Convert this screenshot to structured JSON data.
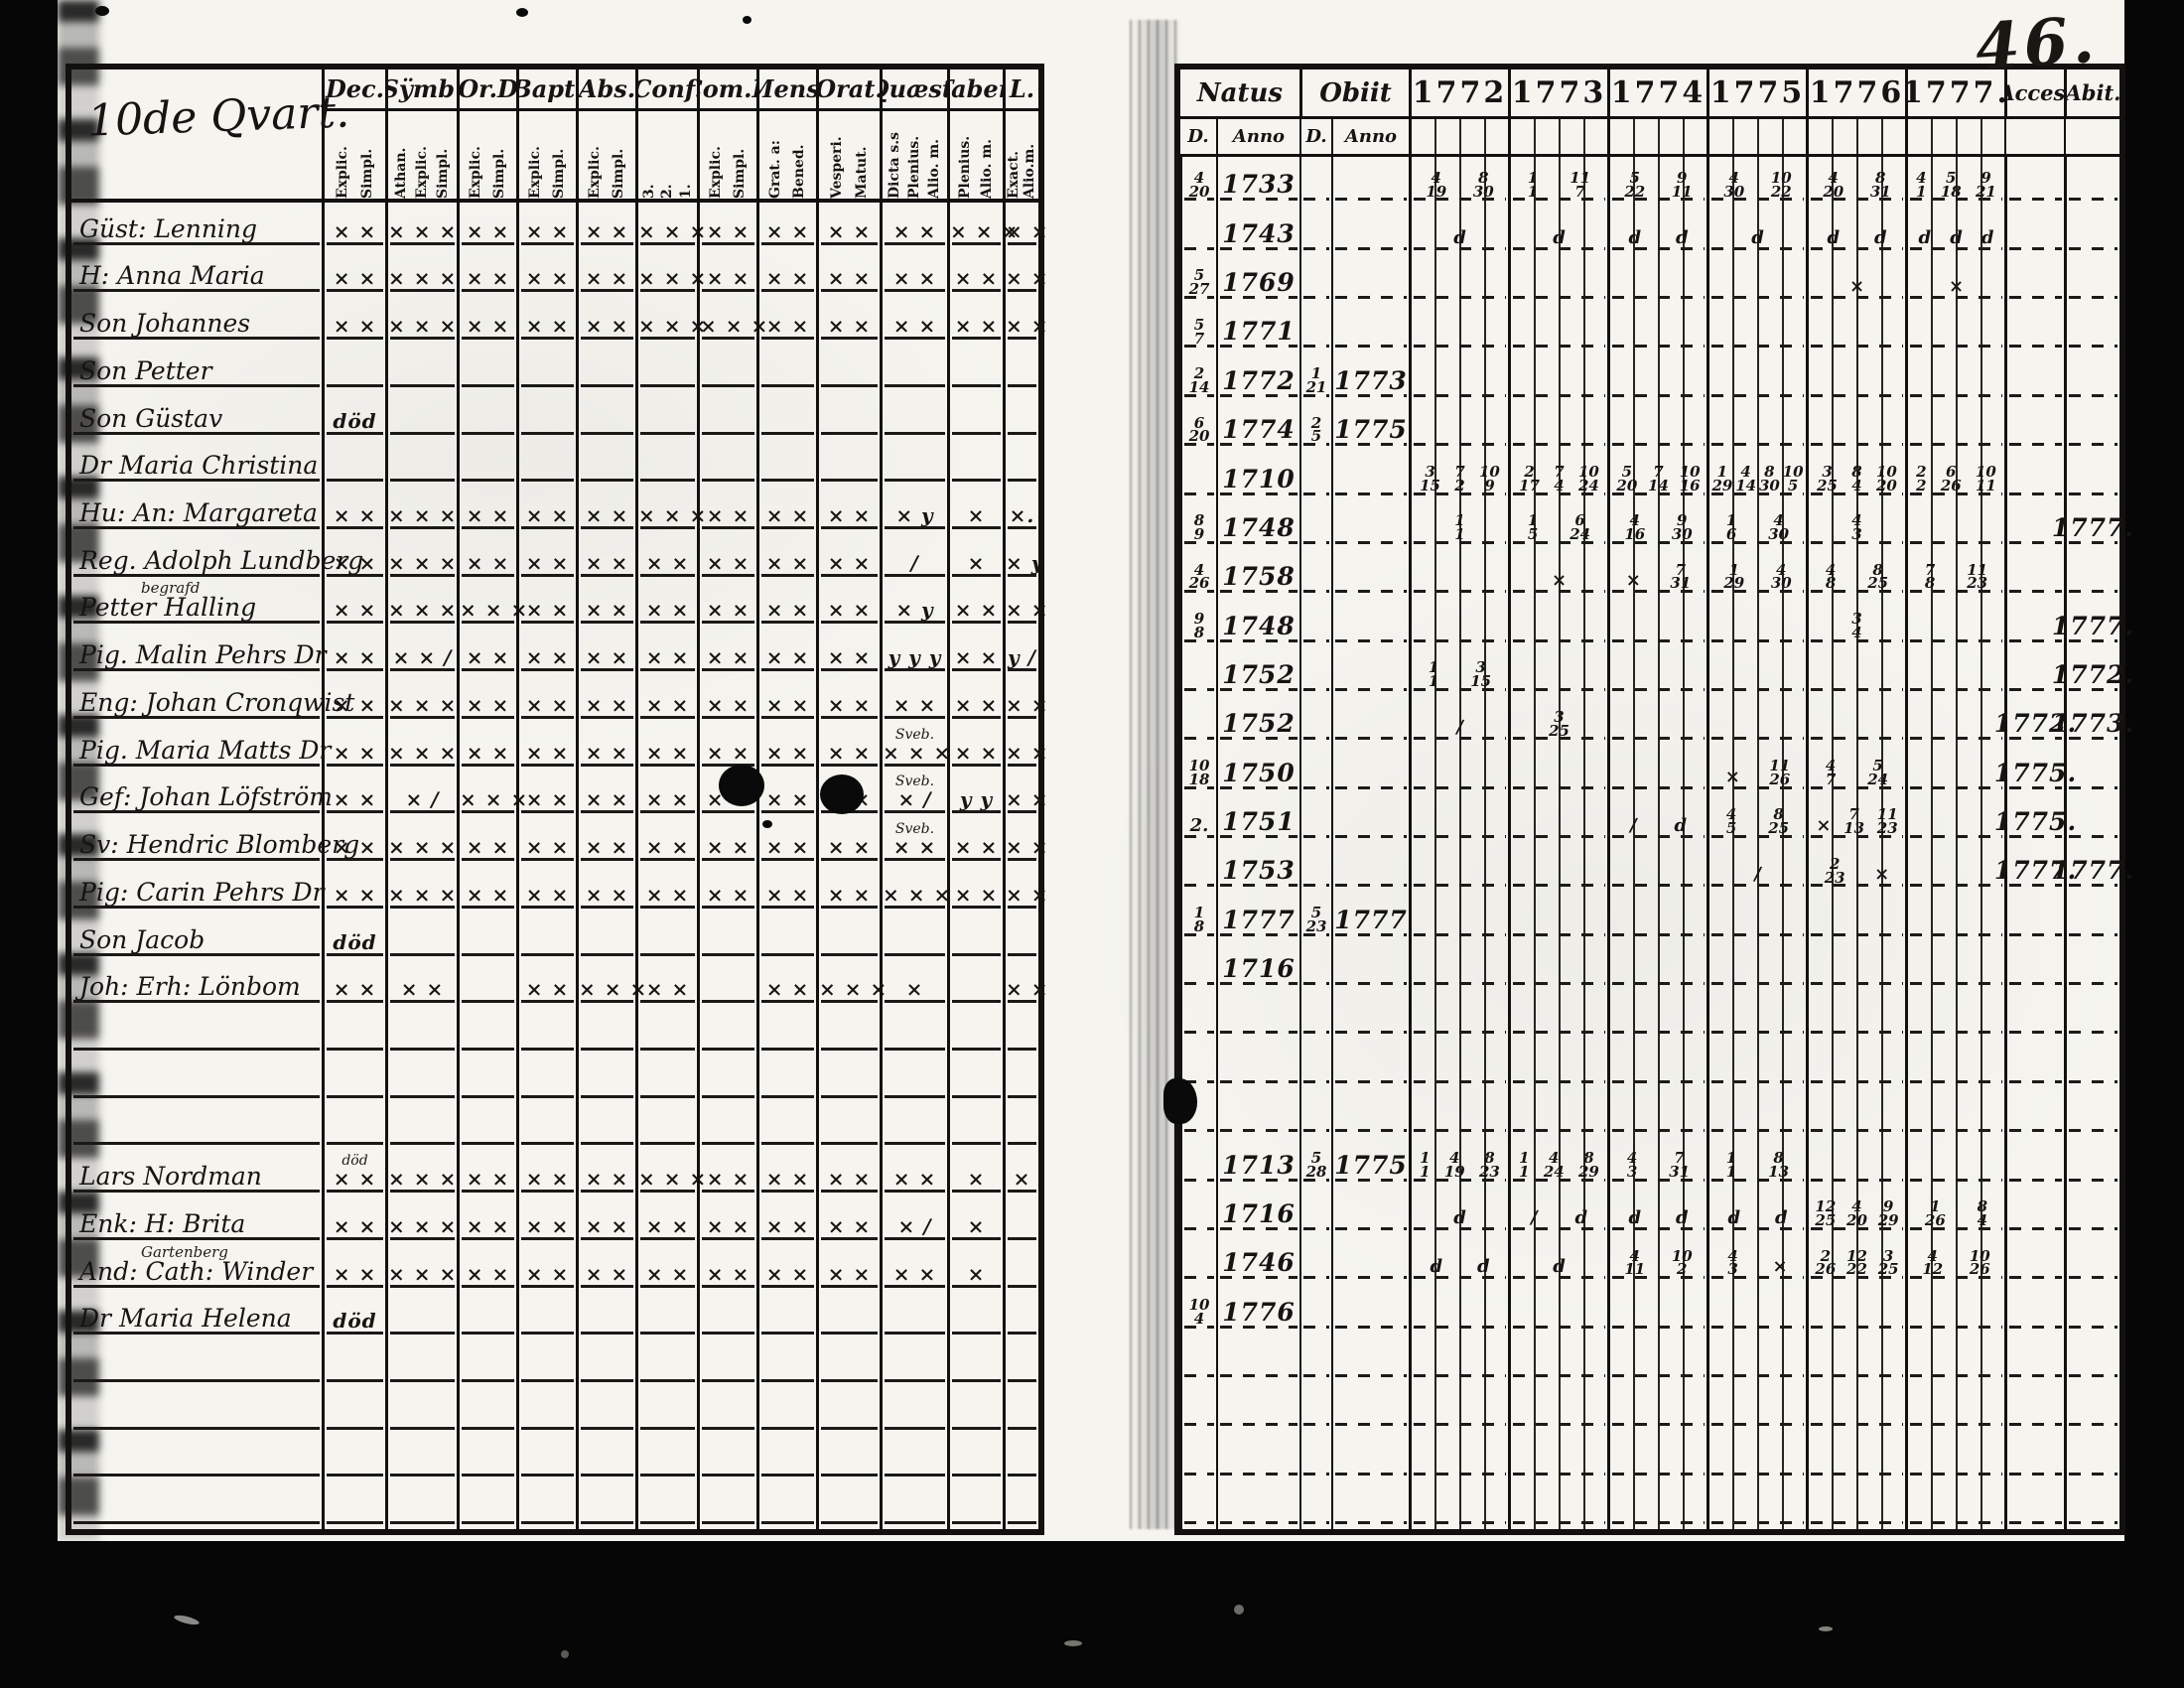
{
  "page_number": "46.",
  "left_table": {
    "title": "10de Qvart.",
    "columns": [
      {
        "label": "Dec.",
        "subs": [
          "Explic.",
          "Simpl."
        ]
      },
      {
        "label": "Sÿmb.",
        "subs": [
          "Athan.",
          "Explic.",
          "Simpl."
        ]
      },
      {
        "label": "Or.D",
        "subs": [
          "Explic.",
          "Simpl."
        ]
      },
      {
        "label": "Bapt.",
        "subs": [
          "Explic.",
          "Simpl."
        ]
      },
      {
        "label": "Abs.",
        "subs": [
          "Explic.",
          "Simpl."
        ]
      },
      {
        "label": "Conf.",
        "subs": [
          "3.",
          "2.",
          "1."
        ]
      },
      {
        "label": "Com.D",
        "subs": [
          "Explic.",
          "Simpl."
        ]
      },
      {
        "label": "Mens.",
        "subs": [
          "Grat. a:",
          "Bened."
        ]
      },
      {
        "label": "Orat.",
        "subs": [
          "Vesperi.",
          "Matut."
        ]
      },
      {
        "label": "Quæst.",
        "subs": [
          "Dicta s.s",
          "Plenius.",
          "Alio. m."
        ]
      },
      {
        "label": "Taber.",
        "subs": [
          "Plenius.",
          "Alio. m."
        ]
      },
      {
        "label": "L.",
        "subs": [
          "Exact.",
          "Alio.m."
        ]
      }
    ],
    "rows": [
      {
        "name": "Güst: Lenning",
        "marks": [
          "× ×",
          "× × ×",
          "× ×",
          "× ×",
          "× ×",
          "× × ×",
          "× ×",
          "× ×",
          "× ×",
          "× ×",
          "× × ×",
          "× ×"
        ]
      },
      {
        "name": "H: Anna Maria",
        "marks": [
          "× ×",
          "× × ×",
          "× ×",
          "× ×",
          "× ×",
          "× × ×",
          "× ×",
          "× ×",
          "× ×",
          "× ×",
          "× ×",
          "× ×"
        ]
      },
      {
        "name": "Son Johannes",
        "marks": [
          "× ×",
          "× × ×",
          "× ×",
          "× ×",
          "× ×",
          "× × ×",
          "× × ×",
          "× ×",
          "× ×",
          "× ×",
          "× ×",
          "× ×"
        ]
      },
      {
        "name": "Son Petter",
        "marks": []
      },
      {
        "name": "Son Güstav",
        "marks": [
          "död"
        ]
      },
      {
        "name": "Dr Maria Christina",
        "marks": []
      },
      {
        "name": "Hu: An: Margareta",
        "marks": [
          "× ×",
          "× × ×",
          "× ×",
          "× ×",
          "× ×",
          "× × ×",
          "× ×",
          "× ×",
          "× ×",
          "× y",
          "×",
          "×."
        ]
      },
      {
        "name": "Reg. Adolph Lundberg",
        "marks": [
          "× ×",
          "× × ×",
          "× ×",
          "× ×",
          "× ×",
          "× ×",
          "× ×",
          "× ×",
          "× ×",
          "∕",
          "×",
          "× y"
        ]
      },
      {
        "name": "Petter Halling",
        "note": "begrafd",
        "marks": [
          "× ×",
          "× × ×",
          "× × ×",
          "× ×",
          "× ×",
          "× ×",
          "× ×",
          "× ×",
          "× ×",
          "× y",
          "× ×",
          "× ×"
        ]
      },
      {
        "name": "Pig. Malin Pehrs Dr",
        "marks": [
          "× ×",
          "× × ∕",
          "× ×",
          "× ×",
          "× ×",
          "× ×",
          "× ×",
          "× ×",
          "× ×",
          "y y y",
          "× ×",
          "y ∕"
        ]
      },
      {
        "name": "Eng: Johan Cronqwist",
        "marks": [
          "× ×",
          "× × ×",
          "× ×",
          "× ×",
          "× ×",
          "× ×",
          "× ×",
          "× ×",
          "× ×",
          "× ×",
          "× ×",
          "× ×"
        ]
      },
      {
        "name": "Pig. Maria Matts Dr",
        "marks": [
          "× ×",
          "× × ×",
          "× ×",
          "× ×",
          "× ×",
          "× ×",
          "× ×",
          "× ×",
          "× ×",
          "Sveb.|× × ×",
          "× ×",
          "× ×"
        ]
      },
      {
        "name": "Gef: Johan Löfström",
        "marks": [
          "× ×",
          "× ∕",
          "× × ×",
          "× ×",
          "× ×",
          "× ×",
          "× ×",
          "× ×",
          "× ×",
          "Sveb.|× ∕",
          "y y",
          "× ×"
        ]
      },
      {
        "name": "Sv: Hendric Blomberg",
        "marks": [
          "× ×",
          "× × ×",
          "× ×",
          "× ×",
          "× ×",
          "× ×",
          "× ×",
          "× ×",
          "× ×",
          "Sveb.|× ×",
          "× ×",
          "× ×"
        ]
      },
      {
        "name": "Pig: Carin Pehrs Dr",
        "marks": [
          "× ×",
          "× × ×",
          "× ×",
          "× ×",
          "× ×",
          "× ×",
          "× ×",
          "× ×",
          "× ×",
          "× × ×",
          "× ×",
          "× ×"
        ]
      },
      {
        "name": "Son Jacob",
        "marks": [
          "död"
        ]
      },
      {
        "name": "Joh: Erh: Lönbom",
        "marks": [
          "× ×",
          "× ×",
          "",
          "× ×",
          "× × ×",
          "× ×",
          "",
          "× ×",
          "× × ×",
          "×",
          "",
          "× ×"
        ]
      },
      {
        "name": "",
        "marks": []
      },
      {
        "name": "",
        "marks": []
      },
      {
        "name": "",
        "marks": []
      },
      {
        "name": "Lars Nordman",
        "marks": [
          "död|× ×",
          "× × ×",
          "× ×",
          "× ×",
          "× ×",
          "× × ×",
          "× ×",
          "× ×",
          "× ×",
          "× ×",
          "×",
          "×"
        ]
      },
      {
        "name": "Enk: H: Brita",
        "marks": [
          "× ×",
          "× × ×",
          "× ×",
          "× ×",
          "× ×",
          "× ×",
          "× ×",
          "× ×",
          "× ×",
          "× ∕",
          "×",
          ""
        ]
      },
      {
        "name": "And: Cath: Winder",
        "note": "Gartenberg",
        "marks": [
          "× ×",
          "× × ×",
          "× ×",
          "× ×",
          "× ×",
          "× ×",
          "× ×",
          "× ×",
          "× ×",
          "× ×",
          "×",
          ""
        ]
      },
      {
        "name": "Dr Maria Helena",
        "marks": [
          "död"
        ]
      },
      {
        "name": "",
        "marks": []
      },
      {
        "name": "",
        "marks": []
      },
      {
        "name": "",
        "marks": []
      },
      {
        "name": "",
        "marks": []
      }
    ]
  },
  "right_table": {
    "natus_label": "Natus",
    "obiit_label": "Obiit",
    "d_label": "D.",
    "anno_label": "Anno",
    "years": [
      "1772",
      "1773",
      "1774",
      "1775",
      "1776",
      "1777."
    ],
    "acces_label": "Acces.",
    "abit_label": "Abit.",
    "rows": [
      {
        "natus_d": "4/20",
        "natus_anno": "1733",
        "obiit_d": "",
        "obiit_anno": "",
        "years": [
          "4/19 8/30",
          "1/1 11/7",
          "5/22 9/11",
          "4/30 10/22",
          "4/20 8/31",
          "4/1 5/18 9/21"
        ],
        "acces": "",
        "abit": ""
      },
      {
        "natus_d": "",
        "natus_anno": "1743",
        "obiit_d": "",
        "obiit_anno": "",
        "years": [
          "d",
          "d",
          "d d",
          "d",
          "d d",
          "d d d"
        ],
        "acces": "",
        "abit": ""
      },
      {
        "natus_d": "5/27",
        "natus_anno": "1769",
        "obiit_d": "",
        "obiit_anno": "",
        "years": [
          "",
          "",
          "",
          "",
          "×",
          "×"
        ],
        "acces": "",
        "abit": ""
      },
      {
        "natus_d": "5/7",
        "natus_anno": "1771",
        "obiit_d": "",
        "obiit_anno": "",
        "years": [
          "",
          "",
          "",
          "",
          "",
          ""
        ],
        "acces": "",
        "abit": ""
      },
      {
        "natus_d": "2/14",
        "natus_anno": "1772",
        "obiit_d": "1/21",
        "obiit_anno": "1773",
        "years": [
          "",
          "",
          "",
          "",
          "",
          ""
        ],
        "acces": "",
        "abit": ""
      },
      {
        "natus_d": "6/20",
        "natus_anno": "1774",
        "obiit_d": "2/5",
        "obiit_anno": "1775",
        "years": [
          "",
          "",
          "",
          "",
          "",
          ""
        ],
        "acces": "",
        "abit": ""
      },
      {
        "natus_d": "",
        "natus_anno": "1710",
        "obiit_d": "",
        "obiit_anno": "",
        "years": [
          "3/15 7/2 10/9",
          "2/17 7/4 10/24",
          "5/20 7/14 10/16",
          "1/29 4/14 8/30 10/5",
          "3/25 8/4 10/20",
          "2/2 6/26 10/11"
        ],
        "acces": "",
        "abit": ""
      },
      {
        "natus_d": "8/9",
        "natus_anno": "1748",
        "obiit_d": "",
        "obiit_anno": "",
        "years": [
          "1/1",
          "1/5 6/24",
          "4/16 9/30",
          "1/6 4/30",
          "4/3",
          ""
        ],
        "acces": "",
        "abit": "1777."
      },
      {
        "natus_d": "4/26",
        "natus_anno": "1758",
        "obiit_d": "",
        "obiit_anno": "",
        "years": [
          "",
          "×",
          "× 7/31",
          "1/29 4/30",
          "4/8 8/25",
          "7/8 11/23"
        ],
        "acces": "",
        "abit": ""
      },
      {
        "natus_d": "9/8",
        "natus_anno": "1748",
        "obiit_d": "",
        "obiit_anno": "",
        "years": [
          "",
          "",
          "",
          "",
          "3/4",
          ""
        ],
        "acces": "",
        "abit": "1777."
      },
      {
        "natus_d": "",
        "natus_anno": "1752",
        "obiit_d": "",
        "obiit_anno": "",
        "years": [
          "1/1 3/15",
          "",
          "",
          "",
          "",
          ""
        ],
        "acces": "",
        "abit": "1772."
      },
      {
        "natus_d": "",
        "natus_anno": "1752",
        "obiit_d": "",
        "obiit_anno": "",
        "years": [
          "∕",
          "3/25",
          "",
          "",
          "",
          ""
        ],
        "acces": "1772.",
        "abit": "1773."
      },
      {
        "natus_d": "10/18",
        "natus_anno": "1750",
        "obiit_d": "",
        "obiit_anno": "",
        "years": [
          "",
          "",
          "",
          "× 11/26",
          "4/7 5/24",
          ""
        ],
        "acces": "1775.",
        "abit": ""
      },
      {
        "natus_d": "2.",
        "natus_anno": "1751",
        "obiit_d": "",
        "obiit_anno": "",
        "years": [
          "",
          "",
          "∕ d",
          "4/5 8/25",
          "× 7/13 11/23",
          ""
        ],
        "acces": "1775.",
        "abit": ""
      },
      {
        "natus_d": "",
        "natus_anno": "1753",
        "obiit_d": "",
        "obiit_anno": "",
        "years": [
          "",
          "",
          "",
          "∕",
          "2/23 ×",
          ""
        ],
        "acces": "1777.",
        "abit": "1777."
      },
      {
        "natus_d": "1/8",
        "natus_anno": "1777",
        "obiit_d": "5/23",
        "obiit_anno": "1777",
        "years": [
          "",
          "",
          "",
          "",
          "",
          ""
        ],
        "acces": "",
        "abit": ""
      },
      {
        "natus_d": "",
        "natus_anno": "1716",
        "obiit_d": "",
        "obiit_anno": "",
        "years": [
          "",
          "",
          "",
          "",
          "",
          ""
        ],
        "acces": "",
        "abit": ""
      },
      {
        "natus_d": "",
        "natus_anno": "",
        "obiit_d": "",
        "obiit_anno": "",
        "years": [
          "",
          "",
          "",
          "",
          "",
          ""
        ],
        "acces": "",
        "abit": ""
      },
      {
        "natus_d": "",
        "natus_anno": "",
        "obiit_d": "",
        "obiit_anno": "",
        "years": [
          "",
          "",
          "",
          "",
          "",
          ""
        ],
        "acces": "",
        "abit": ""
      },
      {
        "natus_d": "",
        "natus_anno": "",
        "obiit_d": "",
        "obiit_anno": "",
        "years": [
          "",
          "",
          "",
          "",
          "",
          ""
        ],
        "acces": "",
        "abit": ""
      },
      {
        "natus_d": "",
        "natus_anno": "1713",
        "obiit_d": "5/28",
        "obiit_anno": "1775",
        "years": [
          "1/1 4/19 8/23",
          "1/1 4/24 8/29",
          "4/3 7/31",
          "1/1 8/13",
          "",
          ""
        ],
        "acces": "",
        "abit": ""
      },
      {
        "natus_d": "",
        "natus_anno": "1716",
        "obiit_d": "",
        "obiit_anno": "",
        "years": [
          "d",
          "∕ d",
          "d d",
          "d d",
          "12/25 4/20 9/29",
          "1/26 8/4"
        ],
        "acces": "",
        "abit": ""
      },
      {
        "natus_d": "",
        "natus_anno": "1746",
        "obiit_d": "",
        "obiit_anno": "",
        "years": [
          "d d",
          "d",
          "4/11 10/2",
          "4/3 ×",
          "2/26 12/22 3/25",
          "4/12 10/26"
        ],
        "acces": "",
        "abit": ""
      },
      {
        "natus_d": "10/4",
        "natus_anno": "1776",
        "obiit_d": "",
        "obiit_anno": "",
        "years": [
          "",
          "",
          "",
          "",
          "",
          ""
        ],
        "acces": "",
        "abit": ""
      },
      {
        "natus_d": "",
        "natus_anno": "",
        "obiit_d": "",
        "obiit_anno": "",
        "years": [
          "",
          "",
          "",
          "",
          "",
          ""
        ],
        "acces": "",
        "abit": ""
      },
      {
        "natus_d": "",
        "natus_anno": "",
        "obiit_d": "",
        "obiit_anno": "",
        "years": [
          "",
          "",
          "",
          "",
          "",
          ""
        ],
        "acces": "",
        "abit": ""
      },
      {
        "natus_d": "",
        "natus_anno": "",
        "obiit_d": "",
        "obiit_anno": "",
        "years": [
          "",
          "",
          "",
          "",
          "",
          ""
        ],
        "acces": "",
        "abit": ""
      },
      {
        "natus_d": "",
        "natus_anno": "",
        "obiit_d": "",
        "obiit_anno": "",
        "years": [
          "",
          "",
          "",
          "",
          "",
          ""
        ],
        "acces": "",
        "abit": ""
      }
    ]
  }
}
